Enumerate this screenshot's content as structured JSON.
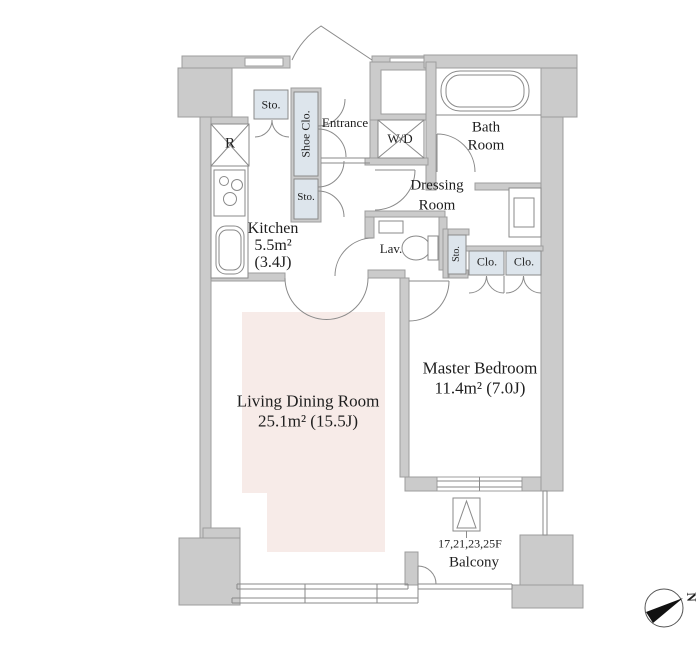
{
  "plan": {
    "rooms": {
      "kitchen": {
        "label": "Kitchen",
        "area": "5.5m²",
        "tatami": "(3.4J)"
      },
      "living_dining": {
        "label": "Living Dining Room",
        "area": "25.1m²  (15.5J)"
      },
      "master_bedroom": {
        "label": "Master Bedroom",
        "area": "11.4m²  (7.0J)"
      },
      "bath": {
        "line1": "Bath",
        "line2": "Room"
      },
      "dressing": {
        "line1": "Dressing",
        "line2": "Room"
      },
      "entrance": {
        "label": "Entrance"
      },
      "lavatory": {
        "label": "Lav."
      },
      "balcony": {
        "label": "Balcony",
        "floors": "17,21,23,25F"
      }
    },
    "storage": {
      "storage_top": "Sto.",
      "shoe_closet": "Shoe Clo.",
      "storage_mid": "Sto.",
      "storage_small": "Sto.",
      "closet_left": "Clo.",
      "closet_right": "Clo."
    },
    "fixtures": {
      "refrigerator": "R",
      "washer_dryer": "W/D"
    },
    "compass": {
      "north_label": "N"
    },
    "colors": {
      "wall": "#cbcbcb",
      "storage_fill": "#dde5ec",
      "living_floor": "#f7ebe8",
      "line": "#8a8a8a"
    }
  }
}
